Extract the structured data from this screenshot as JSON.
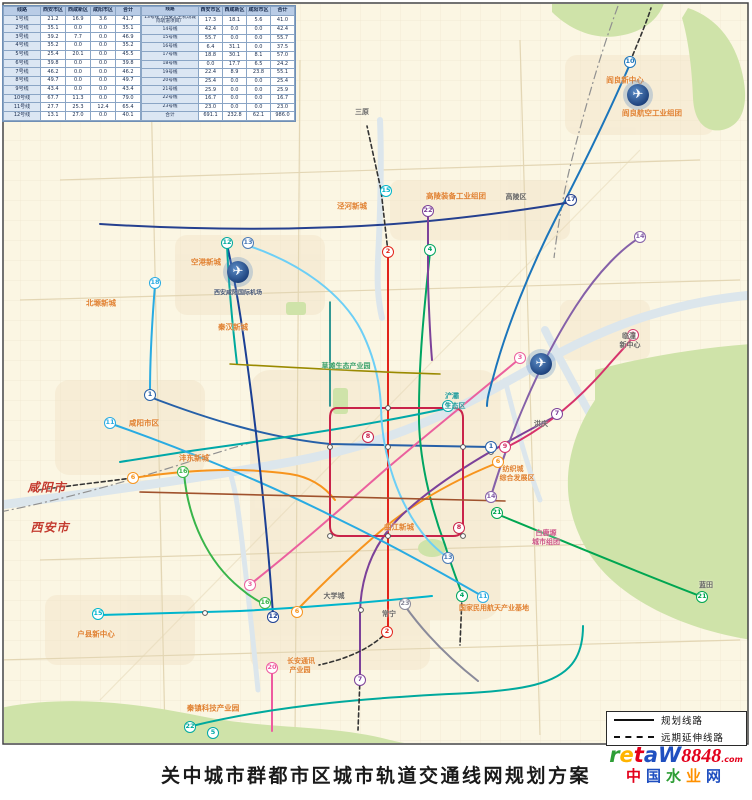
{
  "title": "关中城市群都市区城市轨道交通线网规划方案",
  "table": {
    "headers": [
      "线路",
      "西安市区",
      "西咸新区",
      "咸阳市区",
      "合计"
    ],
    "left_rows": [
      [
        "1号线",
        "21.2",
        "16.9",
        "3.6",
        "41.7"
      ],
      [
        "2号线",
        "35.1",
        "0.0",
        "0.0",
        "35.1"
      ],
      [
        "3号线",
        "39.2",
        "7.7",
        "0.0",
        "46.9"
      ],
      [
        "4号线",
        "35.2",
        "0.0",
        "0.0",
        "35.2"
      ],
      [
        "5号线",
        "25.4",
        "20.1",
        "0.0",
        "45.5"
      ],
      [
        "6号线",
        "39.8",
        "0.0",
        "0.0",
        "39.8"
      ],
      [
        "7号线",
        "46.2",
        "0.0",
        "0.0",
        "46.2"
      ],
      [
        "8号线",
        "49.7",
        "0.0",
        "0.0",
        "49.7"
      ],
      [
        "9号线",
        "43.4",
        "0.0",
        "0.0",
        "43.4"
      ],
      [
        "10号线",
        "67.7",
        "11.3",
        "0.0",
        "79.0"
      ],
      [
        "11号线",
        "27.7",
        "25.3",
        "12.4",
        "65.4"
      ],
      [
        "12号线",
        "13.1",
        "27.0",
        "0.0",
        "40.1"
      ]
    ],
    "right_rows": [
      [
        "13号线（西安北至机场城际轨道项目）",
        "17.3",
        "18.1",
        "5.6",
        "41.0"
      ],
      [
        "14号线",
        "42.4",
        "0.0",
        "0.0",
        "42.4"
      ],
      [
        "15号线",
        "55.7",
        "0.0",
        "0.0",
        "55.7"
      ],
      [
        "16号线",
        "6.4",
        "31.1",
        "0.0",
        "37.5"
      ],
      [
        "17号线",
        "18.8",
        "30.1",
        "8.1",
        "57.0"
      ],
      [
        "18号线",
        "0.0",
        "17.7",
        "6.5",
        "24.2"
      ],
      [
        "19号线",
        "22.4",
        "8.9",
        "23.8",
        "55.1"
      ],
      [
        "20号线",
        "25.4",
        "0.0",
        "0.0",
        "25.4"
      ],
      [
        "21号线",
        "25.9",
        "0.0",
        "0.0",
        "25.9"
      ],
      [
        "22号线",
        "16.7",
        "0.0",
        "0.0",
        "16.7"
      ],
      [
        "23号线",
        "23.0",
        "0.0",
        "0.0",
        "23.0"
      ],
      [
        "合计",
        "691.1",
        "232.8",
        "62.1",
        "986.0"
      ]
    ]
  },
  "legend": {
    "items": [
      {
        "style": "solid",
        "label": "规划线路"
      },
      {
        "style": "dashed",
        "label": "远期延伸线路"
      }
    ]
  },
  "map": {
    "labels": [
      {
        "text": "三原",
        "x": 362,
        "y": 112,
        "c": "#666666",
        "s": 7
      },
      {
        "text": "阎良新中心",
        "x": 625,
        "y": 80,
        "c": "#e08030",
        "s": 7.5
      },
      {
        "text": "阎良航空工业组团",
        "x": 652,
        "y": 113,
        "c": "#e08030",
        "s": 7.5
      },
      {
        "text": "高陵装备工业组团",
        "x": 456,
        "y": 196,
        "c": "#e08030",
        "s": 7.5
      },
      {
        "text": "高陵区",
        "x": 516,
        "y": 197,
        "c": "#666666",
        "s": 7
      },
      {
        "text": "泾河新城",
        "x": 352,
        "y": 206,
        "c": "#e08030",
        "s": 7.5
      },
      {
        "text": "空港新城",
        "x": 206,
        "y": 262,
        "c": "#e08030",
        "s": 7.5
      },
      {
        "text": "西安咸阳国际机场",
        "x": 238,
        "y": 292,
        "c": "#445577",
        "s": 6
      },
      {
        "text": "北塬新城",
        "x": 101,
        "y": 303,
        "c": "#e08030",
        "s": 7.5
      },
      {
        "text": "秦汉新城",
        "x": 233,
        "y": 327,
        "c": "#e08030",
        "s": 7.5
      },
      {
        "text": "草滩生态产业园",
        "x": 346,
        "y": 366,
        "c": "#3aa06a",
        "s": 7
      },
      {
        "text": "咸阳市区",
        "x": 144,
        "y": 423,
        "c": "#e08030",
        "s": 7.5
      },
      {
        "text": "沣东新城",
        "x": 194,
        "y": 458,
        "c": "#e08030",
        "s": 7.5
      },
      {
        "text": "浐灞",
        "x": 452,
        "y": 396,
        "c": "#2aa0a0",
        "s": 7
      },
      {
        "text": "生态区",
        "x": 455,
        "y": 406,
        "c": "#2aa0a0",
        "s": 7
      },
      {
        "text": "纺织城",
        "x": 513,
        "y": 469,
        "c": "#e08030",
        "s": 7
      },
      {
        "text": "综合发展区",
        "x": 517,
        "y": 478,
        "c": "#e08030",
        "s": 7
      },
      {
        "text": "洪庆",
        "x": 541,
        "y": 424,
        "c": "#666666",
        "s": 7
      },
      {
        "text": "临潼",
        "x": 629,
        "y": 336,
        "c": "#666666",
        "s": 7
      },
      {
        "text": "新中心",
        "x": 630,
        "y": 345,
        "c": "#666666",
        "s": 7
      },
      {
        "text": "白鹿塬",
        "x": 546,
        "y": 533,
        "c": "#cc5588",
        "s": 7
      },
      {
        "text": "城市组团",
        "x": 546,
        "y": 542,
        "c": "#cc5588",
        "s": 7
      },
      {
        "text": "蓝田",
        "x": 706,
        "y": 585,
        "c": "#666666",
        "s": 7
      },
      {
        "text": "曲江新城",
        "x": 399,
        "y": 527,
        "c": "#e08030",
        "s": 7.5
      },
      {
        "text": "大学城",
        "x": 334,
        "y": 596,
        "c": "#666666",
        "s": 7
      },
      {
        "text": "常宁",
        "x": 389,
        "y": 614,
        "c": "#666666",
        "s": 7
      },
      {
        "text": "长安通讯",
        "x": 301,
        "y": 661,
        "c": "#e08030",
        "s": 7
      },
      {
        "text": "产业园",
        "x": 300,
        "y": 670,
        "c": "#e08030",
        "s": 7
      },
      {
        "text": "国家民用航天产业基地",
        "x": 494,
        "y": 608,
        "c": "#e08030",
        "s": 7
      },
      {
        "text": "秦镇科技产业园",
        "x": 213,
        "y": 708,
        "c": "#e08030",
        "s": 7.5
      },
      {
        "text": "户县新中心",
        "x": 96,
        "y": 634,
        "c": "#e08030",
        "s": 7.5
      },
      {
        "text": "咸阳市",
        "x": 47,
        "y": 487,
        "c": "#c33a2e",
        "s": 12,
        "b": 1
      },
      {
        "text": "西安市",
        "x": 50,
        "y": 527,
        "c": "#c33a2e",
        "s": 12,
        "b": 1
      }
    ],
    "badges": [
      {
        "n": "10",
        "x": 630,
        "y": 62,
        "c": "#1b75bb"
      },
      {
        "n": "12",
        "x": 227,
        "y": 243,
        "c": "#00a99d"
      },
      {
        "n": "13",
        "x": 248,
        "y": 243,
        "c": "#4a7ab5"
      },
      {
        "n": "18",
        "x": 155,
        "y": 283,
        "c": "#29abe2"
      },
      {
        "n": "15",
        "x": 386,
        "y": 191,
        "c": "#00b5cc"
      },
      {
        "n": "22",
        "x": 428,
        "y": 211,
        "c": "#7c4199"
      },
      {
        "n": "17",
        "x": 571,
        "y": 200,
        "c": "#25408f"
      },
      {
        "n": "14",
        "x": 640,
        "y": 237,
        "c": "#8560a8"
      },
      {
        "n": "9",
        "x": 633,
        "y": 335,
        "c": "#d6336c"
      },
      {
        "n": "2",
        "x": 388,
        "y": 252,
        "c": "#e2231a"
      },
      {
        "n": "4",
        "x": 430,
        "y": 250,
        "c": "#00a562"
      },
      {
        "n": "1",
        "x": 150,
        "y": 395,
        "c": "#2660a8"
      },
      {
        "n": "11",
        "x": 110,
        "y": 423,
        "c": "#29abe2"
      },
      {
        "n": "6",
        "x": 133,
        "y": 478,
        "c": "#f7941d"
      },
      {
        "n": "16",
        "x": 183,
        "y": 472,
        "c": "#39b54a"
      },
      {
        "n": "5",
        "x": 448,
        "y": 406,
        "c": "#00a8a8"
      },
      {
        "n": "8",
        "x": 368,
        "y": 437,
        "c": "#c9234a"
      },
      {
        "n": "8",
        "x": 459,
        "y": 528,
        "c": "#c9234a"
      },
      {
        "n": "1",
        "x": 491,
        "y": 447,
        "c": "#2660a8"
      },
      {
        "n": "9",
        "x": 505,
        "y": 447,
        "c": "#d6336c"
      },
      {
        "n": "6",
        "x": 498,
        "y": 462,
        "c": "#f7941d"
      },
      {
        "n": "7",
        "x": 557,
        "y": 414,
        "c": "#7c4199"
      },
      {
        "n": "3",
        "x": 520,
        "y": 358,
        "c": "#eb609e"
      },
      {
        "n": "3",
        "x": 250,
        "y": 585,
        "c": "#eb609e"
      },
      {
        "n": "14",
        "x": 491,
        "y": 497,
        "c": "#8560a8"
      },
      {
        "n": "21",
        "x": 497,
        "y": 513,
        "c": "#00a651"
      },
      {
        "n": "21",
        "x": 702,
        "y": 597,
        "c": "#00a651"
      },
      {
        "n": "4",
        "x": 462,
        "y": 596,
        "c": "#00a562"
      },
      {
        "n": "11",
        "x": 483,
        "y": 597,
        "c": "#29abe2"
      },
      {
        "n": "13",
        "x": 448,
        "y": 558,
        "c": "#4a7ab5"
      },
      {
        "n": "23",
        "x": 405,
        "y": 604,
        "c": "#8a8a9a"
      },
      {
        "n": "2",
        "x": 387,
        "y": 632,
        "c": "#e2231a"
      },
      {
        "n": "7",
        "x": 360,
        "y": 680,
        "c": "#7c4199"
      },
      {
        "n": "20",
        "x": 272,
        "y": 668,
        "c": "#ee5ba0"
      },
      {
        "n": "16",
        "x": 265,
        "y": 603,
        "c": "#39b54a"
      },
      {
        "n": "12",
        "x": 273,
        "y": 617,
        "c": "#1b3f94"
      },
      {
        "n": "6",
        "x": 297,
        "y": 612,
        "c": "#f7941d"
      },
      {
        "n": "15",
        "x": 98,
        "y": 614,
        "c": "#00b5cc"
      },
      {
        "n": "22",
        "x": 190,
        "y": 727,
        "c": "#00a99d"
      },
      {
        "n": "5",
        "x": 213,
        "y": 733,
        "c": "#00a8a8"
      }
    ],
    "airports": [
      {
        "x": 238,
        "y": 272
      },
      {
        "x": 638,
        "y": 95
      },
      {
        "x": 541,
        "y": 364
      }
    ]
  },
  "watermark": {
    "line1": [
      {
        "ch": "W",
        "c": "#1f4fc0"
      },
      {
        "ch": "a",
        "c": "#1f4fc0"
      },
      {
        "ch": "t",
        "c": "#e3001b"
      },
      {
        "ch": "e",
        "c": "#ffb400"
      },
      {
        "ch": "r",
        "c": "#2e9e36"
      }
    ],
    "number": "8848",
    "suffix": ".com",
    "line2": [
      {
        "ch": "中",
        "c": "#e3001b"
      },
      {
        "ch": "国",
        "c": "#1f4fc0"
      },
      {
        "ch": "水",
        "c": "#2e9e36"
      },
      {
        "ch": "业",
        "c": "#ff9000"
      },
      {
        "ch": "网",
        "c": "#1f4fc0"
      }
    ]
  }
}
